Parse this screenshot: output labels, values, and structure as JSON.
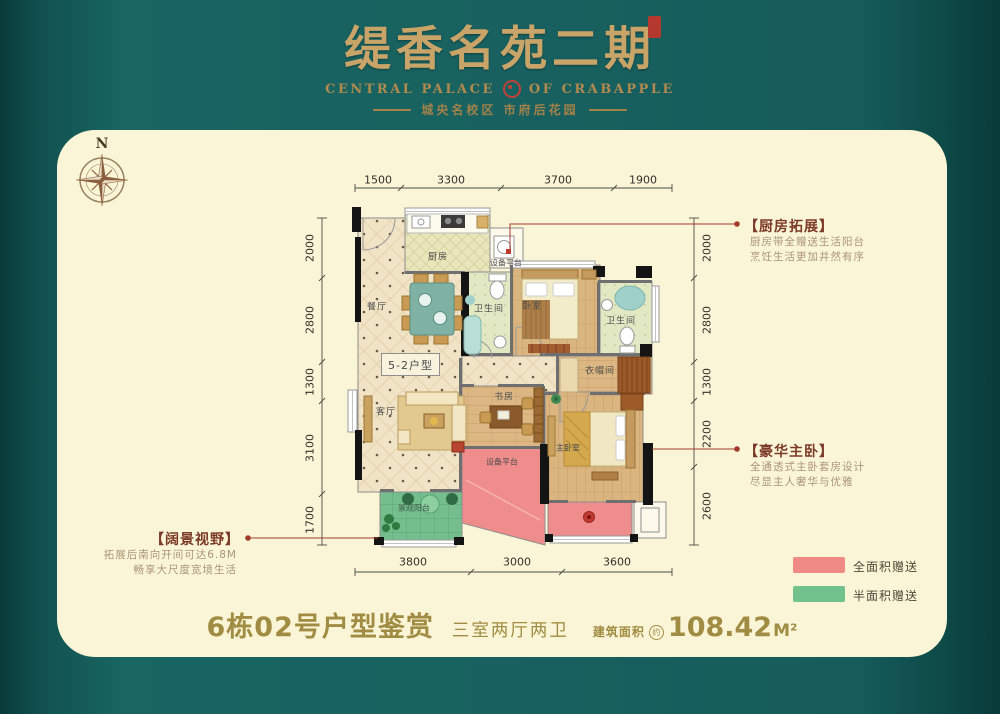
{
  "header": {
    "title": "缇香名苑二期",
    "subtitle_left": "CENTRAL PALACE",
    "subtitle_right": "OF CRABAPPLE",
    "tagline": "城央名校区  市府后花园"
  },
  "compass": {
    "north": "N"
  },
  "plan": {
    "unit_label": "5-2户型",
    "rooms": {
      "kitchen": "厨房",
      "equip_top": "设备平台",
      "bath1": "卫生间",
      "bedroom": "卧室",
      "bath2": "卫生间",
      "cloak": "衣帽间",
      "dining": "餐厅",
      "living": "客厅",
      "study": "书房",
      "equip_mid": "设备平台",
      "master": "主卧室",
      "balcony": "景观阳台"
    },
    "dims": {
      "top": [
        "1500",
        "3300",
        "3700",
        "1900"
      ],
      "left": [
        "2000",
        "2800",
        "1300",
        "3100",
        "1700"
      ],
      "right": [
        "2000",
        "2800",
        "1300",
        "2200",
        "2600"
      ],
      "bottom": [
        "3800",
        "3000",
        "3600"
      ]
    }
  },
  "callouts": {
    "kitchen": {
      "title": "【厨房拓展】",
      "line1": "厨房带全赠送生活阳台",
      "line2": "烹饪生活更加井然有序"
    },
    "master": {
      "title": "【豪华主卧】",
      "line1": "全通透式主卧套房设计",
      "line2": "尽显主人奢华与优雅"
    },
    "view": {
      "title": "【阔景视野】",
      "line1": "拓展后南向开间可达6.8M",
      "line2": "畅享大尺度宽境生活"
    }
  },
  "legend": {
    "full": {
      "label": "全面积赠送",
      "color": "#ef8b84"
    },
    "half": {
      "label": "半面积赠送",
      "color": "#72c28d"
    }
  },
  "footer": {
    "unit": "6栋02号户型鉴赏",
    "layout": "三室两厅两卫",
    "area_label": "建筑面积",
    "area_approx": "约",
    "area_value": "108.42",
    "area_unit": "M²"
  }
}
